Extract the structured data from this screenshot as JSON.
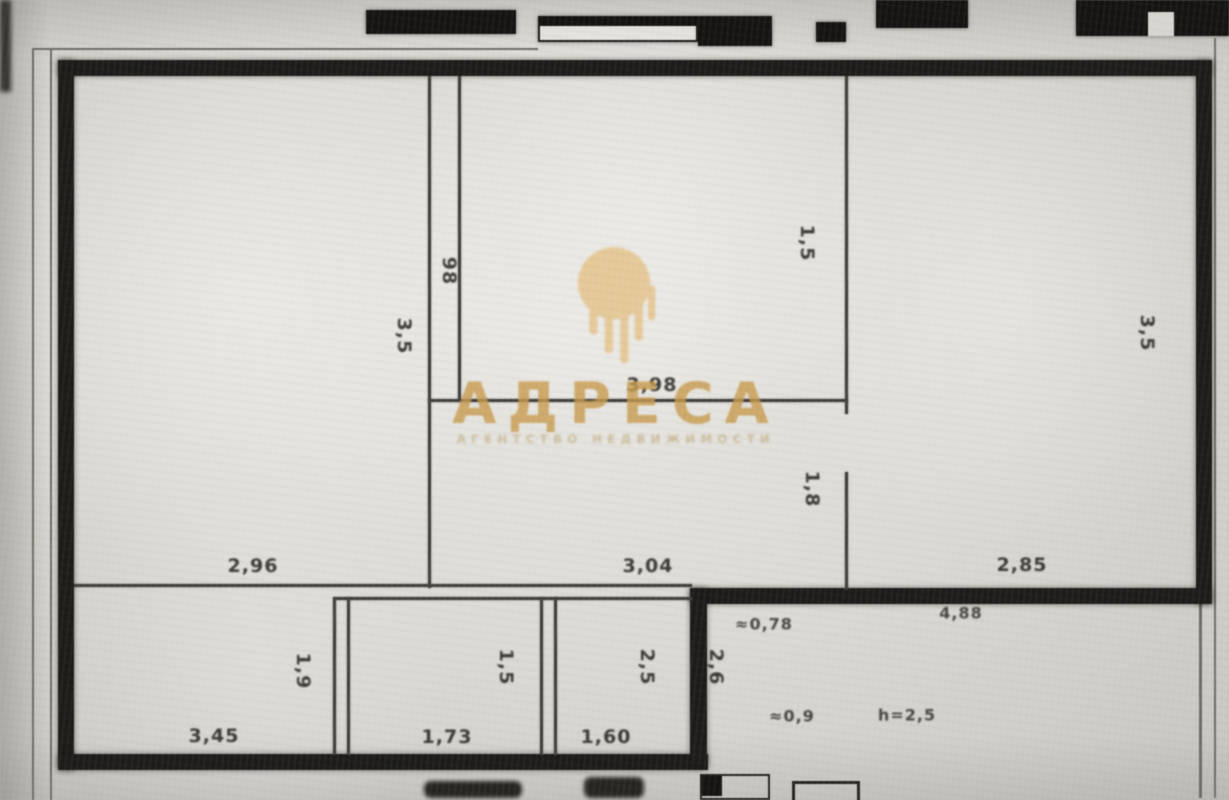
{
  "type": "apartment-floor-plan-photo",
  "watermark": {
    "brand": "АДРЕСА",
    "tagline": "АГЕНТСТВО НЕДВИЖИМОСТИ",
    "logo": "gold-dome-drip-logo",
    "gold_color": "#c89b4e"
  },
  "colors": {
    "paper": "#dcdad5",
    "wall_ink": "#1c1b19",
    "thin_line": "#413f3a",
    "dim_text": "#2c2a26"
  },
  "dimension_labels": {
    "left_room_width": "2,96",
    "hall_width": "3,04",
    "right_room_width": "2,85",
    "middle_room_width": "3,98",
    "bottom_left_room_width": "3,45",
    "bottom_middle_room_width": "1,73",
    "bottom_right_room_width": "1,60",
    "outside_offset": "≈0,78",
    "outside_width": "4,88",
    "outside_small_width": "≈0,9",
    "ceiling_height": "h=2,5",
    "left_room_height": "3,5",
    "shaft_width": "98",
    "middle_wall_height": "1,5",
    "door_height": "1,8",
    "right_room_height": "3,5",
    "bottom_left_room_height": "1,9",
    "bottom_middle_room_height": "1,5",
    "bottom_right_room_height": "2,5",
    "outside_height": "2,6"
  }
}
